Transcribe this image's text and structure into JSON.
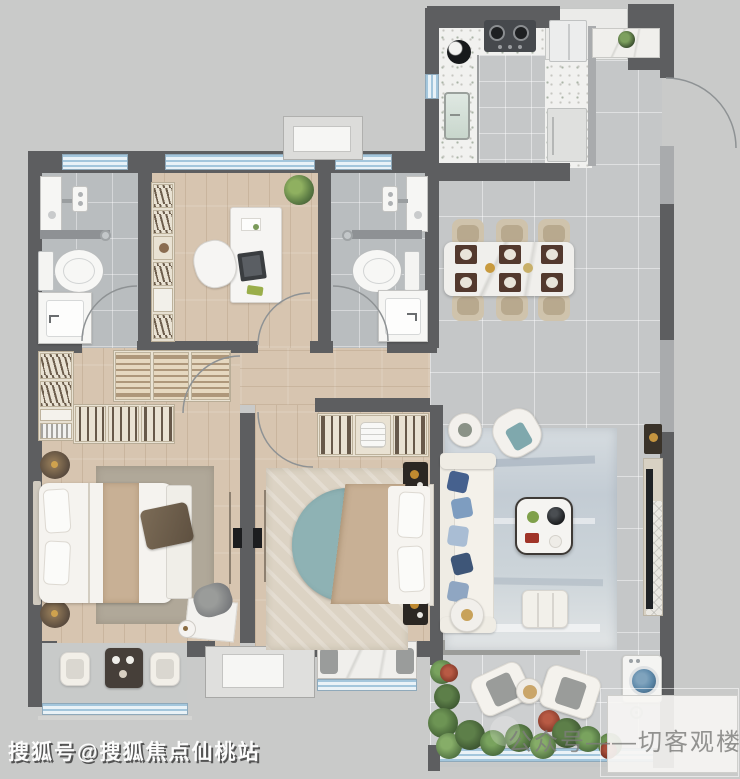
{
  "watermarks": {
    "bottom_left": "搜狐号@搜狐焦点仙桃站",
    "bottom_right": "公众号——切客观楼市"
  },
  "palette": {
    "canvas_bg": "#c9cac9",
    "wall_dark": "#5d5e60",
    "wall_light": "#a9abad",
    "tile_grey": "#c5c7c8",
    "bath_tile": "#b9bdbf",
    "wood_floor": "#d7c5b0",
    "window_blue": "#a3c6dc",
    "counter_speckle": "#f1f1ef",
    "rug_master": "#b0a899",
    "rug_living": "#ccd4da",
    "bed_teal": "#8eb2b4",
    "bed_tan": "#c8b095",
    "sofa_white": "#f2efe8",
    "pillow_navy": "#46618e",
    "plant_green": "#6b8f55",
    "plant_red": "#9e4937",
    "washer_drum": "#5b87a8",
    "stove_dark": "#46494d"
  }
}
